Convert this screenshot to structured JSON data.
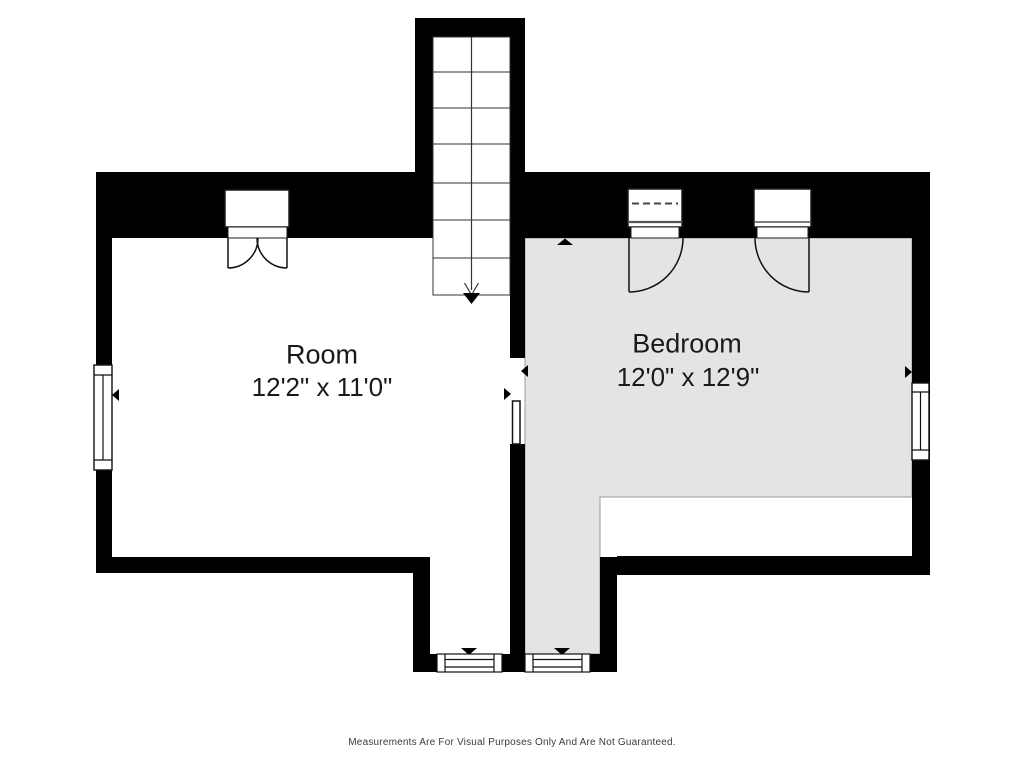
{
  "floorplan": {
    "rooms": [
      {
        "name": "Room",
        "dimensions": "12'2\" x 11'0\""
      },
      {
        "name": "Bedroom",
        "dimensions": "12'0\" x 12'9\""
      }
    ],
    "disclaimer": "Measurements Are For Visual Purposes Only And Are Not Guaranteed.",
    "colors": {
      "wall": "#000000",
      "bedroom_fill": "#e4e4e4",
      "floor_fill": "#ffffff",
      "detail_line": "#111111",
      "label_text": "#1a1a1a",
      "disclaimer_text": "#3c3c3c"
    }
  }
}
